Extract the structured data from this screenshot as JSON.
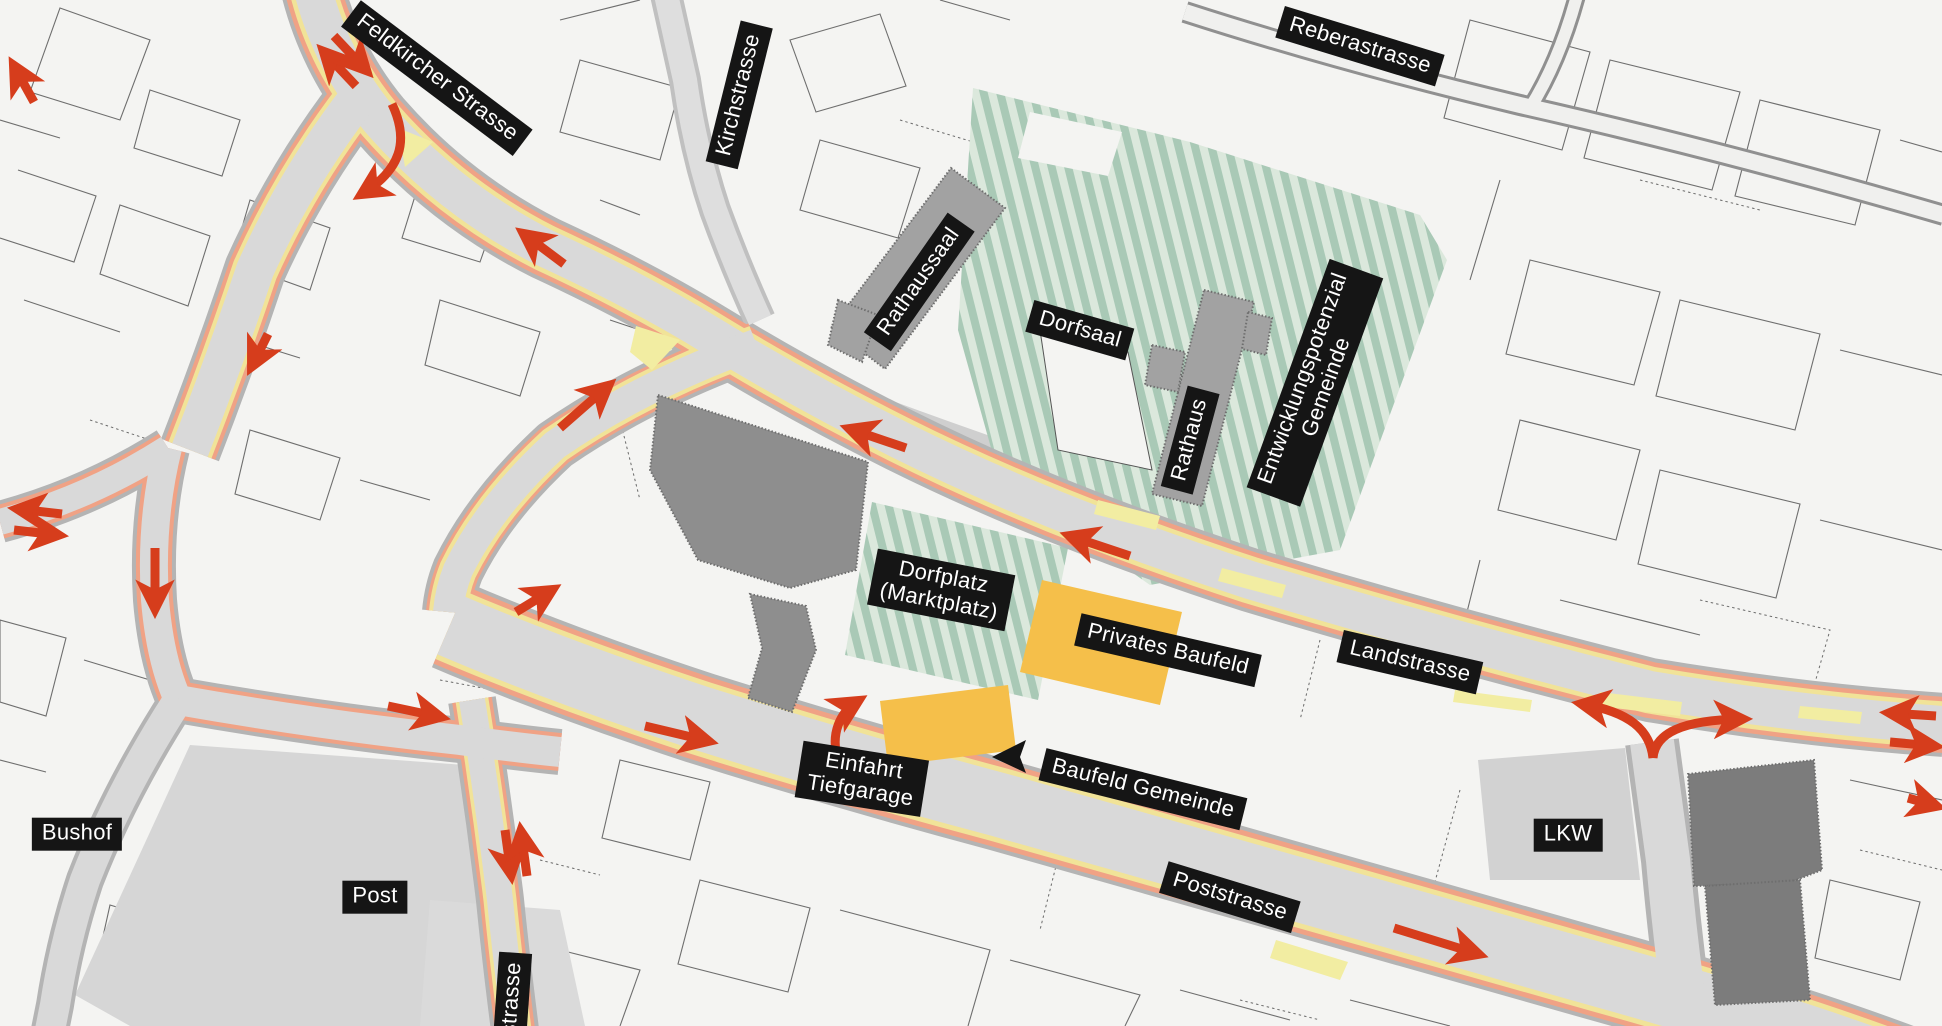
{
  "map": {
    "title": "Village centre traffic and development plan",
    "labels": [
      {
        "id": "street-feldkircher-strasse",
        "text": "Feldkircher Strasse"
      },
      {
        "id": "street-kirchstrasse",
        "text": "Kirchstrasse"
      },
      {
        "id": "street-reberastrasse",
        "text": "Reberastrasse"
      },
      {
        "id": "building-rathaussaal",
        "text": "Rathaussaal"
      },
      {
        "id": "building-dorfsaal",
        "text": "Dorfsaal"
      },
      {
        "id": "building-rathaus",
        "text": "Rathaus"
      },
      {
        "id": "area-entwicklungspotenzial",
        "text": "Entwicklungspotenzial\nGemeinde"
      },
      {
        "id": "area-dorfplatz",
        "text": "Dorfplatz\n(Marktplatz)"
      },
      {
        "id": "area-privates-baufeld",
        "text": "Privates Baufeld"
      },
      {
        "id": "street-landstrasse",
        "text": "Landstrasse"
      },
      {
        "id": "poi-einfahrt-tiefgarage",
        "text": "Einfahrt\nTiefgarage"
      },
      {
        "id": "area-baufeld-gemeinde",
        "text": "Baufeld Gemeinde"
      },
      {
        "id": "poi-bushof",
        "text": "Bushof"
      },
      {
        "id": "poi-post",
        "text": "Post"
      },
      {
        "id": "street-fstrasse-partial",
        "text": "fstrasse"
      },
      {
        "id": "street-poststrasse",
        "text": "Poststrasse"
      },
      {
        "id": "poi-lkw",
        "text": "LKW"
      }
    ],
    "colors": {
      "background": "#f4f4f2",
      "road_fill": "#d9d9d9",
      "road_casing": "#b4b4b4",
      "road_edge_orange": "#f0a285",
      "road_edge_yellow": "#f1e398",
      "traffic_island_yellow": "#f2eda2",
      "flow_arrow_red": "#d63d1c",
      "green_hatch_dark": "#a9c9b6",
      "green_hatch_light": "#dbe8dc",
      "building_gray": "#a2a2a2",
      "building_dark_gray": "#7c7c7c",
      "field_yellow": "#f5bf4a",
      "label_bg": "#151515",
      "label_fg": "#ffffff"
    }
  }
}
